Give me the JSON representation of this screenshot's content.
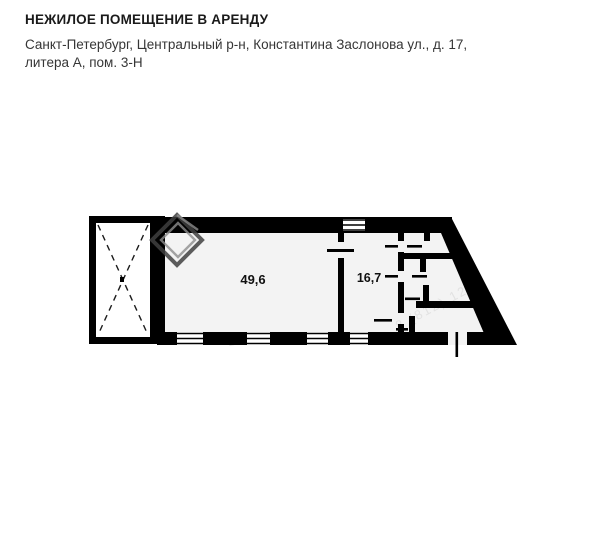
{
  "header": {
    "title": "НЕЖИЛОЕ ПОМЕЩЕНИЕ В АРЕНДУ",
    "address_line1": "Санкт-Петербург, Центральный р-н, Константина Заслонова ул., д. 17,",
    "address_line2": "литера А, пом. 3-Н"
  },
  "floor_plan": {
    "room_large_area": "49,6",
    "room_small_area": "16,7",
    "watermark_fragments": [
      "8 (812) 12-2",
      "21"
    ],
    "colors": {
      "wall": "#000000",
      "room_fill": "#f3f3f3",
      "title_text": "#1a1a1a",
      "address_text": "#363636",
      "watermark": "#e2e2e2"
    }
  }
}
